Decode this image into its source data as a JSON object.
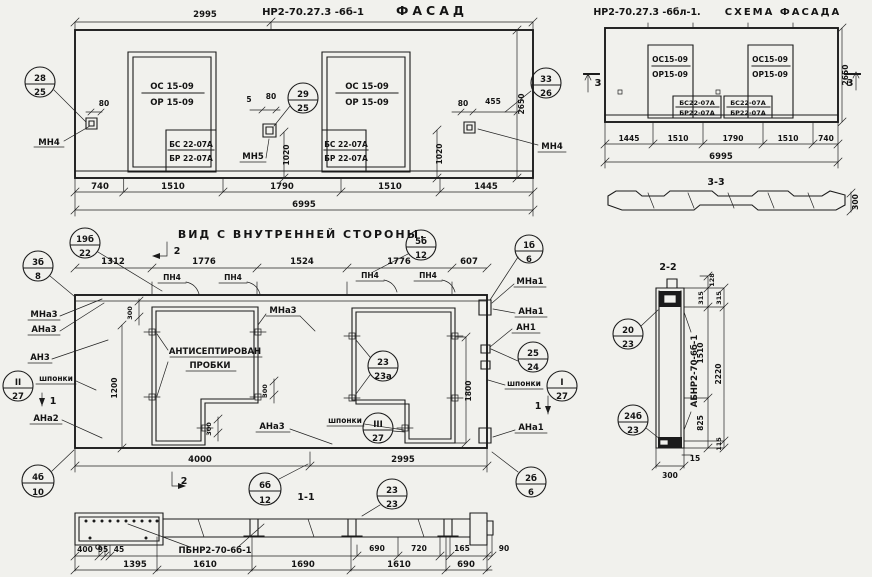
{
  "facade": {
    "dim_top": "2995",
    "code": "НР2-70.27.3 -6б-1",
    "title": "ФАСАД",
    "win1": {
      "os": "ОС 15-09",
      "or": "ОР 15-09",
      "bs": "БС 22-07А",
      "br": "БР 22-07А"
    },
    "win2": {
      "os": "ОС 15-09",
      "or": "ОР 15-09",
      "bs": "БС 22-07А",
      "br": "БР 22-07А"
    },
    "mn4_left": "МН4",
    "mn5": "МН5",
    "mn4_right": "МН4",
    "c28": {
      "t": "28",
      "b": "25"
    },
    "c29": {
      "t": "29",
      "b": "25"
    },
    "c33": {
      "t": "33",
      "b": "26"
    },
    "d80_left": "80",
    "d5": "5",
    "d80_mid": "80",
    "d1020_mid": "1020",
    "d80_right": "80",
    "d455": "455",
    "d1020_right": "1020",
    "d2650": "2650",
    "dims_bottom": [
      "740",
      "1510",
      "1790",
      "1510",
      "1445"
    ],
    "dim_total": "6995"
  },
  "schema": {
    "code": "НР2-70.27.3 -6бл-1.",
    "title": "СХЕМА ФАСАДА",
    "sec_left": "3",
    "sec_right": "3",
    "win1": {
      "os": "ОС15-09",
      "or": "ОР15-09",
      "bs": "БС22-07А",
      "br": "БР22-07А"
    },
    "win2": {
      "os": "ОС15-09",
      "or": "ОР15-09",
      "bs": "БС22-07А",
      "br": "БР22-07А"
    },
    "d2650": "2650",
    "dims_bottom": [
      "1445",
      "1510",
      "1790",
      "1510",
      "740"
    ],
    "dim_total": "6995",
    "s33": {
      "label": "3-3",
      "d300": "300"
    }
  },
  "inner": {
    "title": "ВИД С ВНУТРЕННЕЙ СТОРОНЫ.",
    "dims_top": [
      "1312",
      "1776",
      "1524",
      "1776",
      "607"
    ],
    "pn4": "ПН4",
    "sec2_top": "2",
    "sec2_bottom": "2",
    "sec1_left": "1",
    "sec1_right": "1",
    "c19b": {
      "t": "19б",
      "b": "22"
    },
    "c3b": {
      "t": "3б",
      "b": "8"
    },
    "c5b": {
      "t": "5б",
      "b": "12"
    },
    "c1b": {
      "t": "1б",
      "b": "6"
    },
    "cII": {
      "t": "II",
      "b": "27"
    },
    "c4b": {
      "t": "4б",
      "b": "10"
    },
    "c23": {
      "t": "23",
      "b": "23а"
    },
    "cIII": {
      "t": "III",
      "b": "27"
    },
    "c25": {
      "t": "25",
      "b": "24"
    },
    "cI": {
      "t": "I",
      "b": "27"
    },
    "c2b": {
      "t": "2б",
      "b": "6"
    },
    "c6b": {
      "t": "6б",
      "b": "12"
    },
    "mna3_left": "МНа3",
    "ana3_left": "АНа3",
    "an3": "АН3",
    "shponki_left": "шпонки",
    "ana2": "АНа2",
    "mna3_mid": "МНа3",
    "antiseptic1": "АНТИСЕПТИРОВАН",
    "antiseptic2": "ПРОБКИ",
    "ana3_mid": "АНа3",
    "shponki_mid": "шпонки",
    "mna1": "МНа1",
    "ana1_top": "АНа1",
    "an1": "АН1",
    "shponki_right": "шпонки",
    "ana1_bottom": "АНа1",
    "d300_a": "300",
    "d300_b": "300",
    "d300_c": "300",
    "d1200": "1200",
    "d1800": "1800",
    "d4000": "4000",
    "d2995": "2995"
  },
  "sec11": {
    "label": "1-1",
    "beam_code": "ПБНР2-70-6б-1",
    "c23": {
      "t": "23",
      "b": "23"
    },
    "dims_r1": [
      "400",
      "95",
      "45",
      "690",
      "720",
      "165",
      "90"
    ],
    "dims_r2": [
      "1395",
      "1610",
      "1690",
      "1610",
      "690"
    ]
  },
  "sec22": {
    "label": "2-2",
    "code": "АБНР2-70-6б-1",
    "c20": {
      "t": "20",
      "b": "23"
    },
    "c24b": {
      "t": "24б",
      "b": "23"
    },
    "d128": "128",
    "d315_a": "315",
    "d315_b": "315",
    "d1510": "1510",
    "d2220": "2220",
    "d825": "825",
    "d115": "115",
    "d15": "15",
    "d300": "300"
  }
}
